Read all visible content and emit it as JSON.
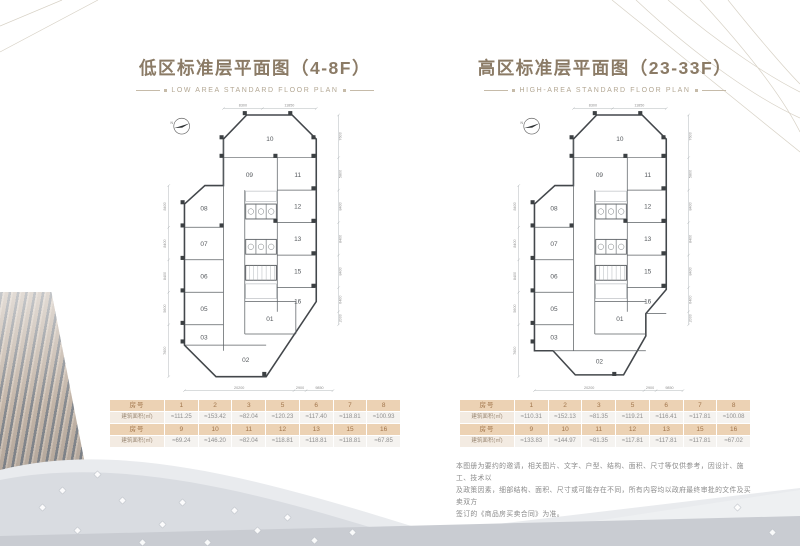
{
  "low_panel": {
    "title": "低区标准层平面图（4-8F）",
    "subtitle": "LOW AREA STANDARD FLOOR PLAN",
    "plan": {
      "north": "N",
      "rooms": [
        "10",
        "09",
        "11",
        "08",
        "12",
        "07",
        "13",
        "06",
        "15",
        "05",
        "16",
        "03",
        "01",
        "02"
      ],
      "dims_top": [
        "8300",
        "11850"
      ],
      "dims_bottom": [
        "20200",
        "2900",
        "9850"
      ],
      "dims_left": [
        "8400",
        "8400",
        "8400",
        "5600",
        "7600"
      ],
      "dims_right": [
        "7600",
        "5800",
        "8400",
        "8400",
        "8400",
        "6400",
        "2000"
      ]
    },
    "table": {
      "row_header": "房号",
      "area_header": "建筑面积(㎡)",
      "rows": [
        {
          "units": [
            "1",
            "2",
            "3",
            "5",
            "6",
            "7",
            "8"
          ],
          "areas": [
            "≈111.25",
            "≈153.42",
            "≈82.04",
            "≈120.23",
            "≈117.40",
            "≈118.81",
            "≈100.93"
          ]
        },
        {
          "units": [
            "9",
            "10",
            "11",
            "12",
            "13",
            "15",
            "16"
          ],
          "areas": [
            "≈69.24",
            "≈146.20",
            "≈82.04",
            "≈118.81",
            "≈118.81",
            "≈118.81",
            "≈67.85"
          ]
        }
      ]
    }
  },
  "high_panel": {
    "title": "高区标准层平面图（23-33F）",
    "subtitle": "HIGH-AREA STANDARD FLOOR PLAN",
    "plan": {
      "north": "N",
      "rooms": [
        "10",
        "09",
        "11",
        "08",
        "12",
        "07",
        "13",
        "06",
        "15",
        "05",
        "16",
        "03",
        "01",
        "02"
      ],
      "dims_top": [
        "8300",
        "11850"
      ],
      "dims_bottom": [
        "20200",
        "2900",
        "9850"
      ],
      "dims_left": [
        "8400",
        "8400",
        "8400",
        "5600",
        "7600"
      ],
      "dims_right": [
        "7600",
        "5800",
        "8400",
        "8400",
        "8400",
        "6400",
        "2000"
      ]
    },
    "table": {
      "row_header": "房号",
      "area_header": "建筑面积(㎡)",
      "rows": [
        {
          "units": [
            "1",
            "2",
            "3",
            "5",
            "6",
            "7",
            "8"
          ],
          "areas": [
            "≈110.31",
            "≈152.13",
            "≈81.35",
            "≈119.21",
            "≈116.41",
            "≈117.81",
            "≈100.08"
          ]
        },
        {
          "units": [
            "9",
            "10",
            "11",
            "12",
            "13",
            "15",
            "16"
          ],
          "areas": [
            "≈133.83",
            "≈144.97",
            "≈81.35",
            "≈117.81",
            "≈117.81",
            "≈117.81",
            "≈67.02"
          ]
        }
      ]
    }
  },
  "disclaimer": {
    "lines": [
      "本图册为要约的邀请，相关图片、文字、户型、结构、面积、尺寸等仅供参考，因设计、施工、技术以",
      "及政策因素，细部结构、面积、尺寸或可能存在不同，所有内容均以政府最终审批的文件及买卖双方",
      "签订的《商品房买卖合同》为准。"
    ]
  },
  "colors": {
    "accent_tan": "#ecd2b4",
    "accent_brown": "#a0744a",
    "title_brown": "#8b7b66",
    "wall_dark": "#43474b",
    "wave_gray": "#d9dce1"
  }
}
